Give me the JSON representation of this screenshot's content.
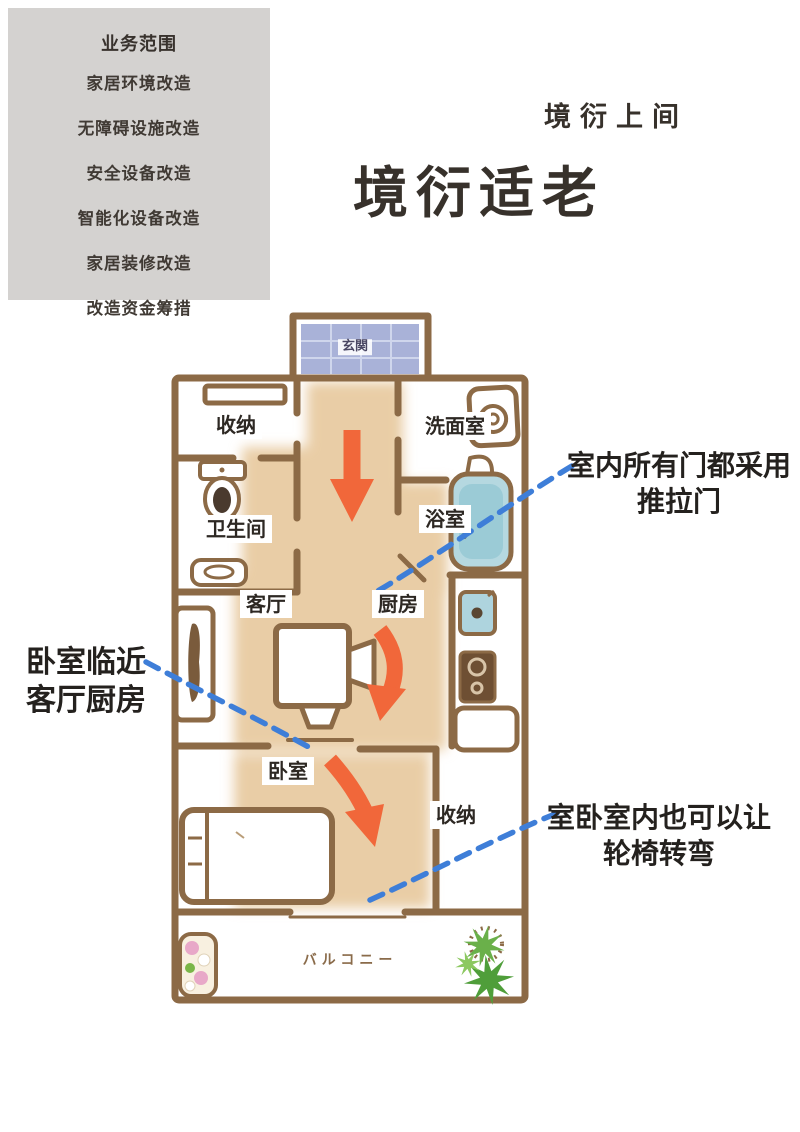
{
  "sidebar": {
    "header": "业务范围",
    "items": [
      "家居环境改造",
      "无障碍设施改造",
      "安全设备改造",
      "智能化设备改造",
      "家居装修改造",
      "改造资金筹措"
    ]
  },
  "header": {
    "brand": "境衍上间",
    "title": "境衍适老"
  },
  "floorplan": {
    "rooms": {
      "entrance": "玄関",
      "storage_top": "收纳",
      "toilet": "卫生间",
      "washroom": "洗面室",
      "bathroom": "浴室",
      "living": "客厅",
      "kitchen": "厨房",
      "bedroom": "卧室",
      "storage_bottom": "收纳",
      "balcony": "バルコニー"
    },
    "annotations": {
      "sliding_doors": {
        "line1": "室内所有门都采用",
        "line2": "推拉门"
      },
      "bedroom_near": {
        "line1": "卧室临近",
        "line2": "客厅厨房"
      },
      "wheelchair": {
        "line1": "室卧室内也可以让",
        "line2": "轮椅转弯"
      }
    },
    "icons": [
      "toilet-icon",
      "sink-icon",
      "washing-machine-icon",
      "laundry-basin-icon",
      "bathtub-icon",
      "kitchen-sink-icon",
      "stove-icon",
      "counter-icon",
      "tv-table-icon",
      "cabinet-icon",
      "bed-icon",
      "flower-plant-icon",
      "green-plant-icon",
      "route-arrow-icon",
      "callout-dash-line"
    ]
  },
  "colors": {
    "sidebar_bg": "#d4d2d0",
    "wall_brown": "#8c6a46",
    "floor_tan": "#e9cda6",
    "tile_blue": "#a9b2d8",
    "bath_blue": "#aed3dc",
    "arrow_orange": "#f1673a",
    "dash_blue": "#3e7ed8",
    "text_dark": "#37312b",
    "plant_green": "#5fae3e",
    "flower_pink": "#e8a8c8"
  }
}
